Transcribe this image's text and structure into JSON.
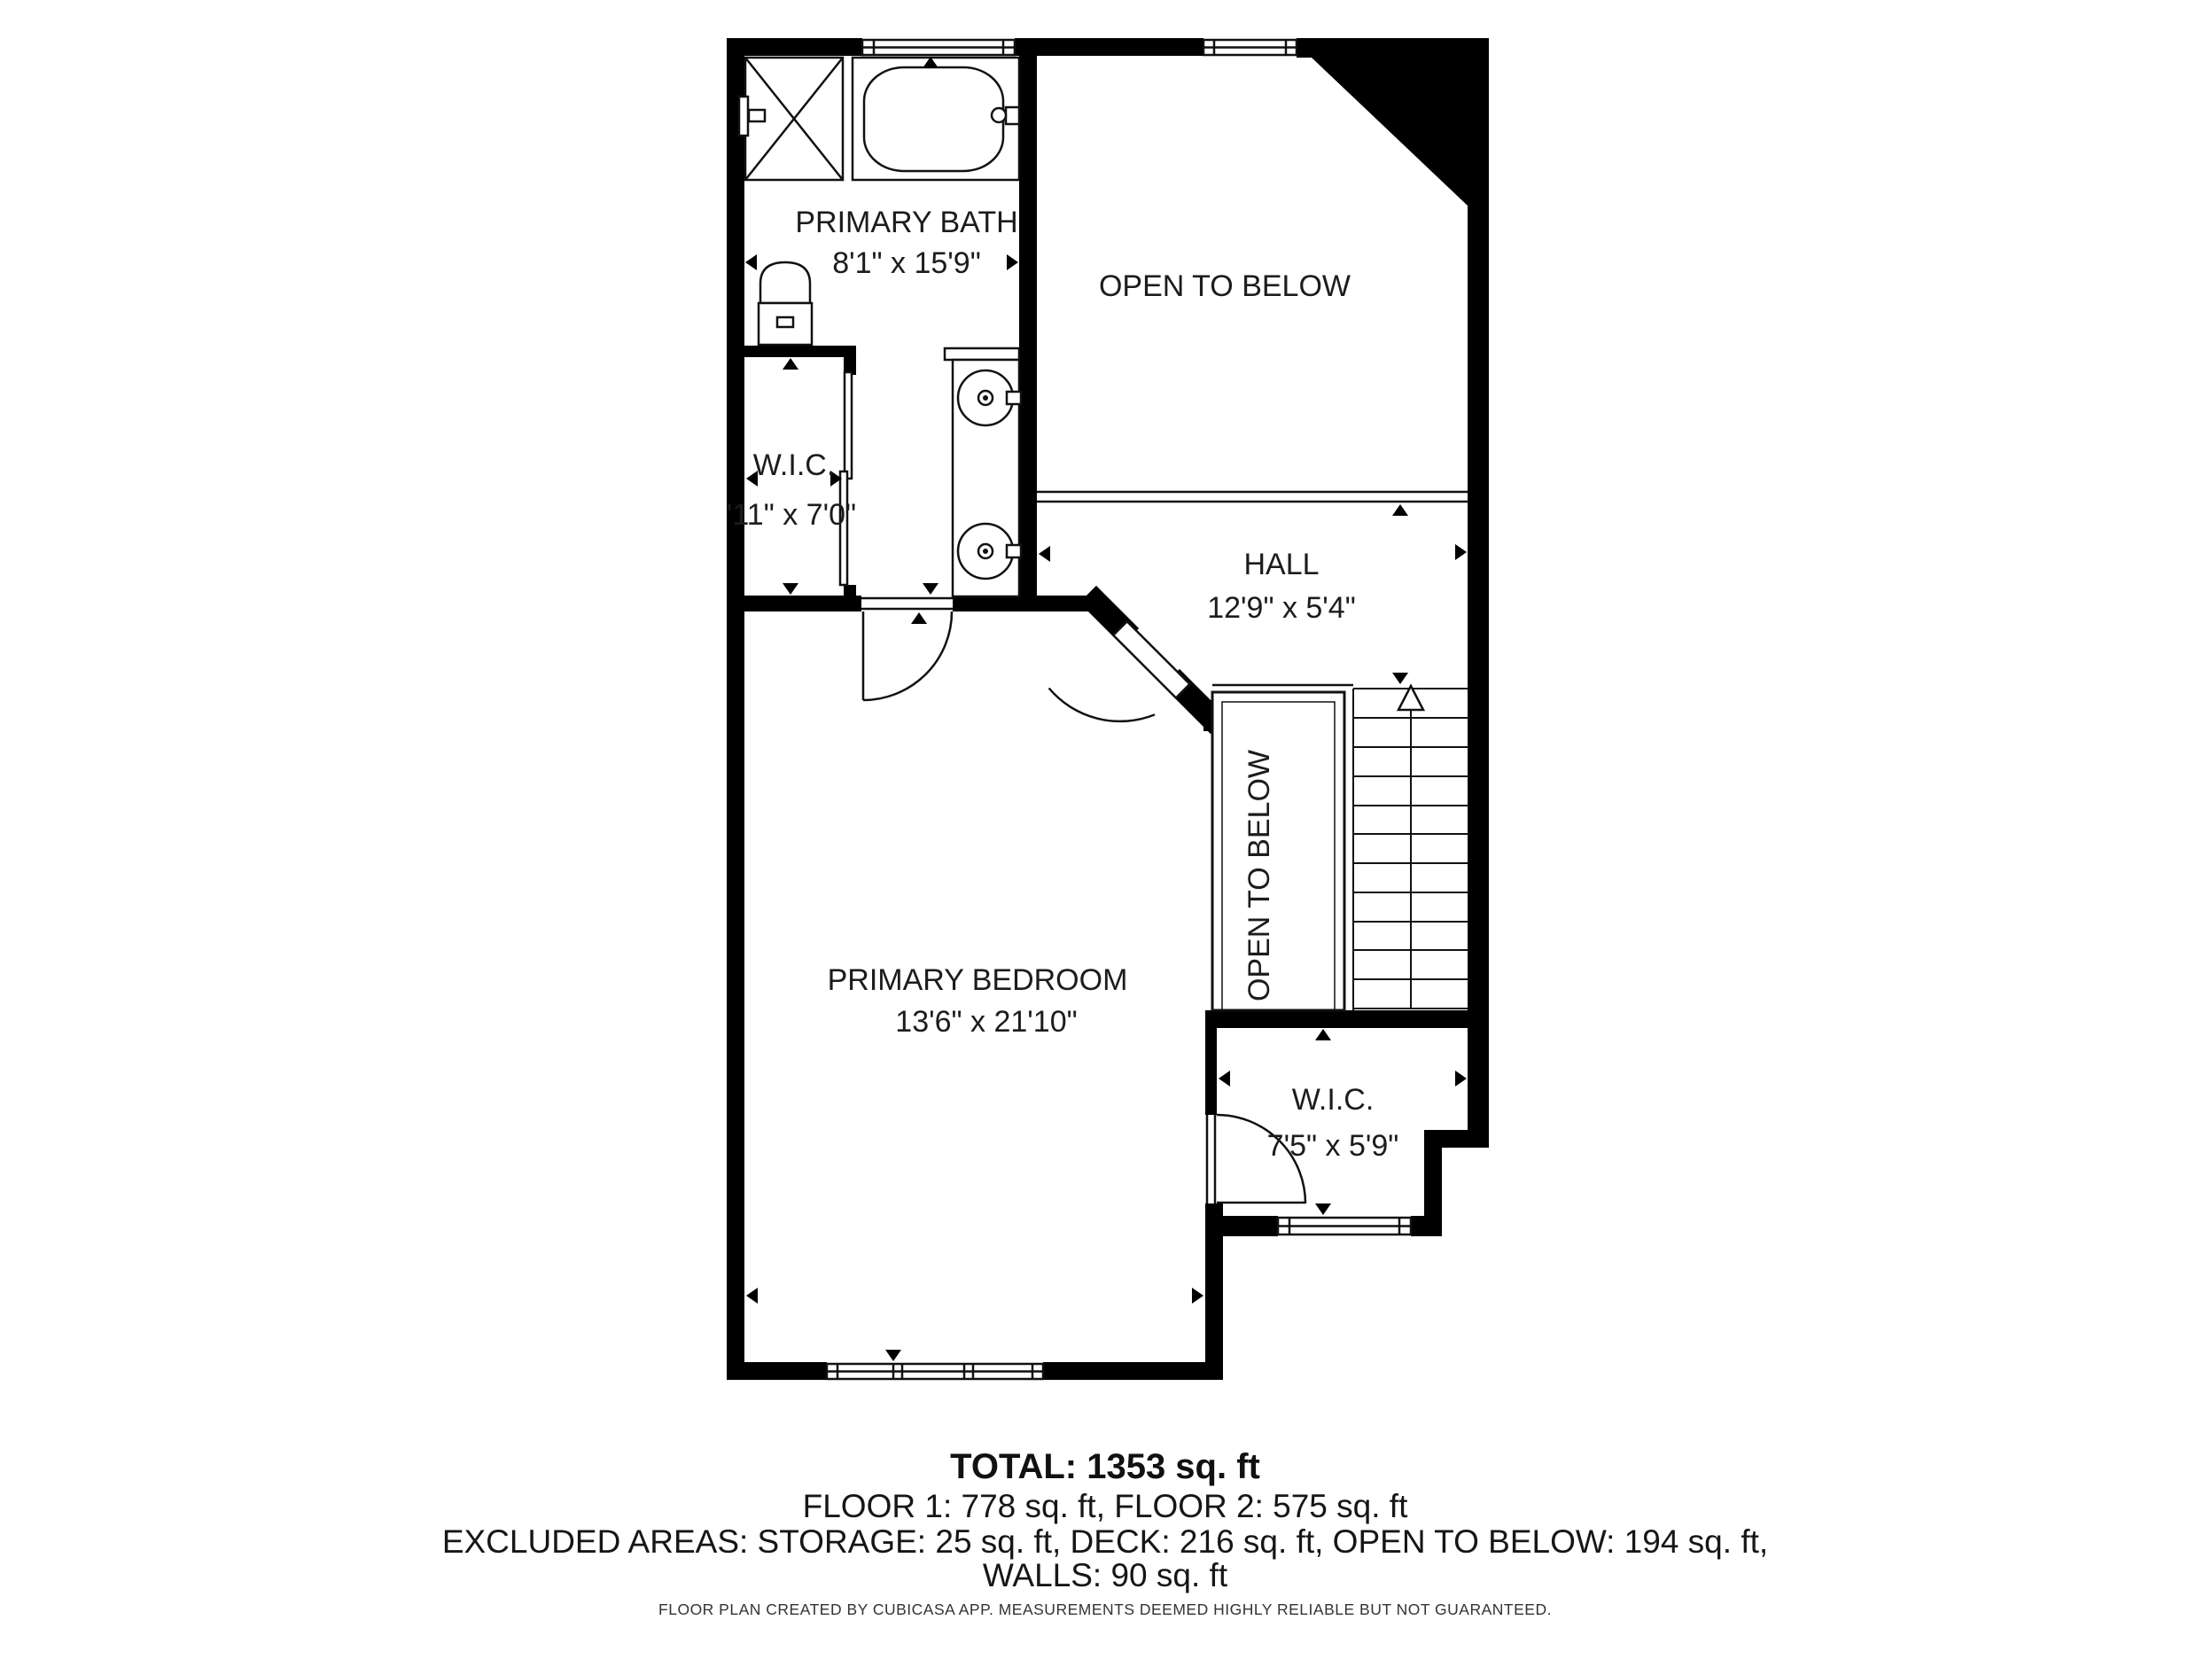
{
  "plan": {
    "rooms": {
      "primary_bath": {
        "name": "PRIMARY BATH",
        "dims": "8'1\" x 15'9\""
      },
      "open_to_below_top": {
        "name": "OPEN TO BELOW"
      },
      "wic_left": {
        "name": "W.I.C.",
        "dims": "'11\" x 7'0\""
      },
      "hall": {
        "name": "HALL",
        "dims": "12'9\" x 5'4\""
      },
      "primary_bedroom": {
        "name": "PRIMARY BEDROOM",
        "dims": "13'6\" x 21'10\""
      },
      "open_to_below_stairs": {
        "name": "OPEN TO BELOW"
      },
      "wic_bottom": {
        "name": "W.I.C.",
        "dims": "7'5\" x 5'9\""
      }
    },
    "colors": {
      "wall": "#000000",
      "text": "#1c1c1c",
      "background": "#ffffff"
    }
  },
  "summary": {
    "total": "TOTAL: 1353 sq. ft",
    "floors": "FLOOR 1: 778 sq. ft, FLOOR 2: 575 sq. ft",
    "excluded": "EXCLUDED AREAS: STORAGE: 25 sq. ft, DECK: 216 sq. ft, OPEN TO BELOW: 194 sq. ft,",
    "walls": "WALLS: 90 sq. ft",
    "disclaimer": "FLOOR PLAN CREATED BY CUBICASA APP. MEASUREMENTS DEEMED HIGHLY RELIABLE BUT NOT GUARANTEED."
  }
}
